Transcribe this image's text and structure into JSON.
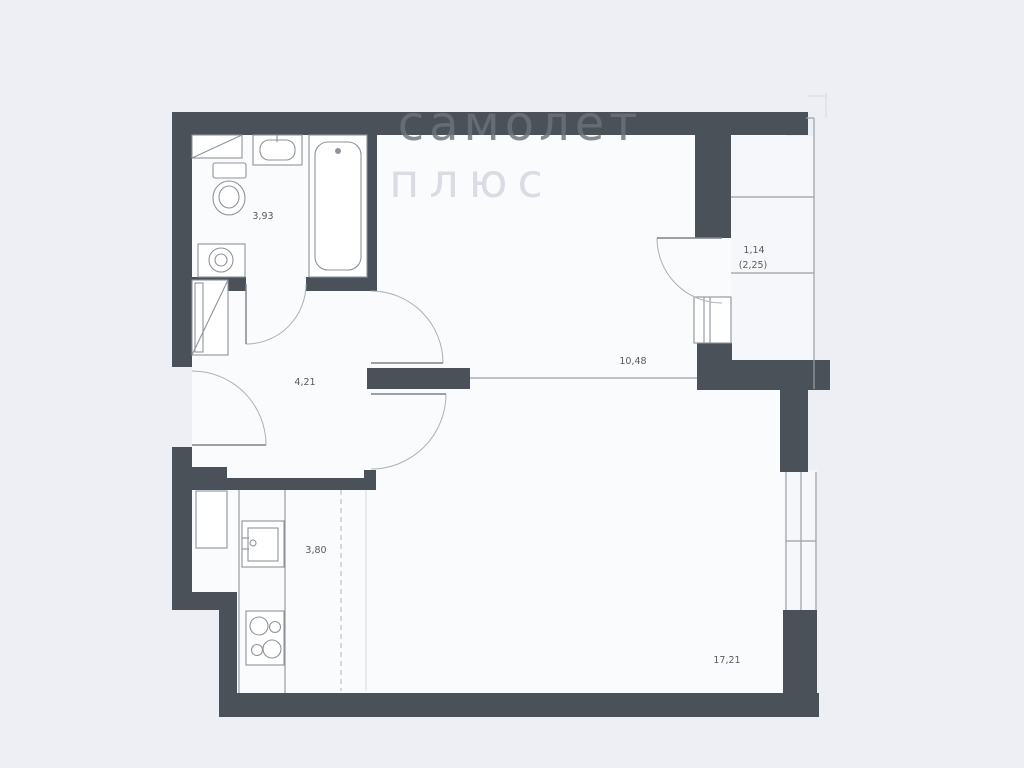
{
  "watermark": {
    "line1": "самолет",
    "line2": "плюс"
  },
  "rooms": {
    "bathroom": {
      "name": "bathroom",
      "area": "3,93"
    },
    "hallway": {
      "name": "hallway",
      "area": "4,21"
    },
    "corridor": {
      "name": "corridor",
      "area": "10,48"
    },
    "kitchen": {
      "name": "kitchen",
      "area": "3,80"
    },
    "living": {
      "name": "living-room",
      "area": "17,21"
    },
    "balcony": {
      "name": "balcony",
      "area": "1,14",
      "area_unreduced": "(2,25)"
    }
  },
  "colors": {
    "wall": "#4b5159",
    "floor": "#fafbfd",
    "background": "#edeff4",
    "thin_line": "#9aa0a8",
    "label_text": "#565b63",
    "watermark_dark": "#6d727a",
    "watermark_light": "#d9dce2"
  }
}
